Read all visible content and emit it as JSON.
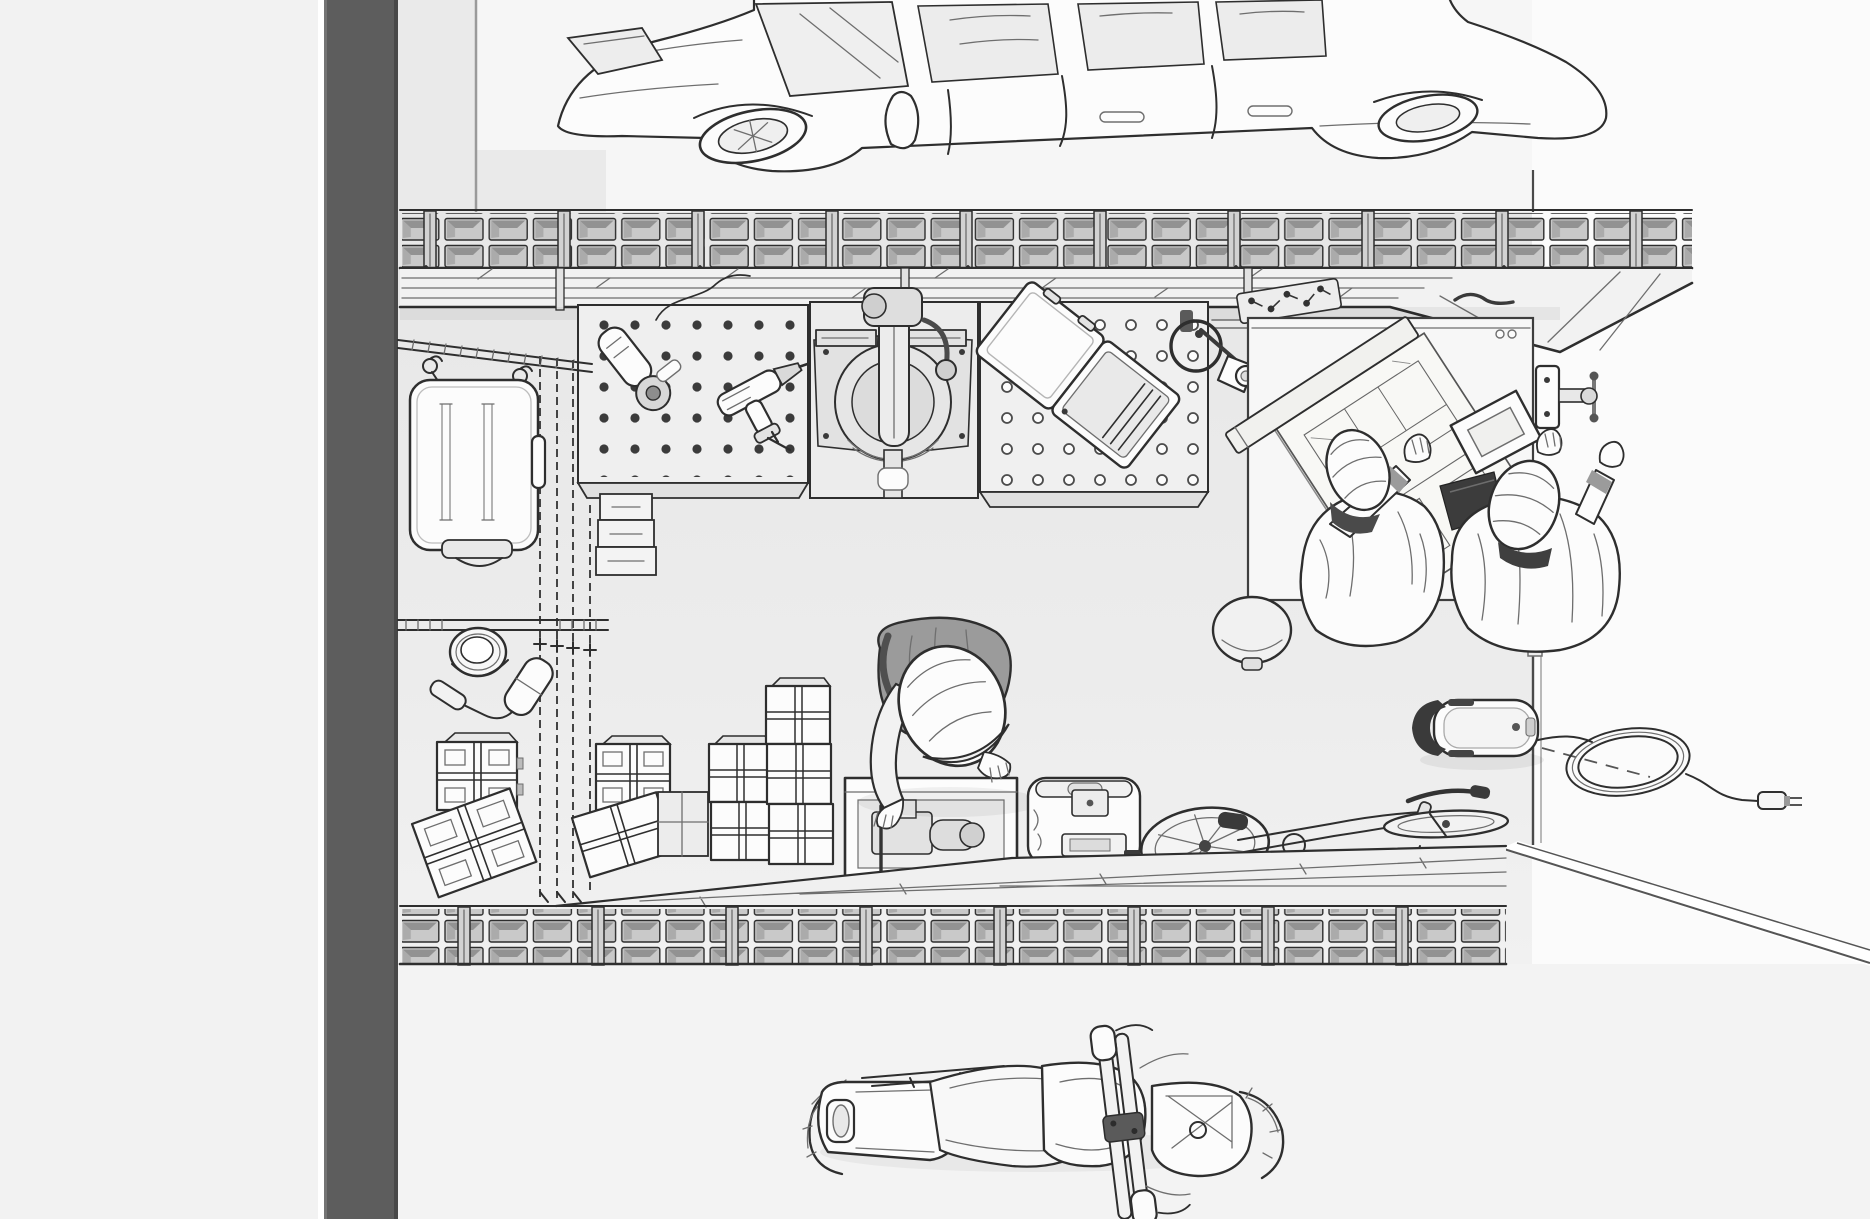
{
  "meta": {
    "title": "Garage workshop — top-down technical line illustration",
    "description": "Monochrome top-down illustration of a garage: car parked above a two-row bin storage wall, overhead plank shelf, three workbenches (pegboard with grinder and drill, miter saw, perforated bench with open tool case and clamp lamp), a drafting desk where two workers in ridged hard hats lean over blueprints with a straightedge, picture frame and bench vise, a rolling stool, wall rails with a hanging tool case, paint can and roller, cross-strapped moving boxes and box towers, a worker in a hard hat bending into an open crate of machine parts, a generator case, a bicycle, a robotic mower with a coiled power cord and plug at the doorway, a second bin wall with plank floor strip, and a motorcycle parked on the apron below.",
    "canvas": {
      "width": 1870,
      "height": 1219
    }
  },
  "colors": {
    "paper": "#fbfbfb",
    "margin": "#f2f2f2",
    "bar": "#5d5d5d",
    "bar-edge": "#484848",
    "ink": "#2e2e2e",
    "ink2": "#6e6e6e",
    "floor": "#e9e9e9",
    "floor2": "#f3f3f3",
    "white": "#fcfcfc",
    "grey": "#e3e3e3",
    "bin-face": "#c9c9c9",
    "bin-shade": "#929292",
    "shirt": "#9b9b9b",
    "dark": "#3a3a3a",
    "paperline": "#8a8a8a"
  },
  "objects": [
    {
      "name": "car",
      "label": "car parked along storage wall, top view"
    },
    {
      "name": "top-storage-rack",
      "label": "two-row open bin storage wall"
    },
    {
      "name": "overhead-plank-shelf",
      "label": "overhead plank shelf in perspective"
    },
    {
      "name": "pegboard-bench-left",
      "label": "pegboard workbench"
    },
    {
      "name": "angle-grinder",
      "label": "power grinder on bench"
    },
    {
      "name": "power-drill",
      "label": "cordless drill on bench"
    },
    {
      "name": "miter-saw",
      "label": "compound miter saw bench"
    },
    {
      "name": "pegboard-bench-right",
      "label": "perforated-top workbench"
    },
    {
      "name": "tool-case-open",
      "label": "open tool case on bench"
    },
    {
      "name": "desk-lamp",
      "label": "clamp-on articulated lamp"
    },
    {
      "name": "fastener-tray",
      "label": "tray of screws and bits"
    },
    {
      "name": "drafting-desk",
      "label": "planning desk"
    },
    {
      "name": "blueprints",
      "label": "floor-plan drawings"
    },
    {
      "name": "straightedge-board",
      "label": "long straightedge over drawings"
    },
    {
      "name": "picture-frame",
      "label": "framed plan on desk"
    },
    {
      "name": "bench-vise",
      "label": "vise on desk edge"
    },
    {
      "name": "worker-left",
      "label": "worker in ridged hard hat at desk"
    },
    {
      "name": "worker-right",
      "label": "second worker in hard hat at desk"
    },
    {
      "name": "clipboard",
      "label": "dark tablet between workers"
    },
    {
      "name": "rolling-stool",
      "label": "round stool"
    },
    {
      "name": "hanging-tool-case",
      "label": "large case hanging on wall rail"
    },
    {
      "name": "wall-rails",
      "label": "wall rails, hooks, vertical tracks"
    },
    {
      "name": "paint-can",
      "label": "open paint can"
    },
    {
      "name": "paint-roller",
      "label": "paint roller"
    },
    {
      "name": "strapped-boxes",
      "label": "cross-strapped storage boxes"
    },
    {
      "name": "box-towers",
      "label": "stacked box towers"
    },
    {
      "name": "step-drawers",
      "label": "stacked drawers under bench"
    },
    {
      "name": "work-crate",
      "label": "open crate with machine parts"
    },
    {
      "name": "worker-bending",
      "label": "worker bending over crate"
    },
    {
      "name": "generator-case",
      "label": "portable generator case"
    },
    {
      "name": "bicycle",
      "label": "bicycle on floor strip"
    },
    {
      "name": "robot-mower",
      "label": "robotic mower at doorway"
    },
    {
      "name": "power-cord",
      "label": "coiled cord with plug"
    },
    {
      "name": "bottom-storage-rack",
      "label": "front bin storage wall with plank strip"
    },
    {
      "name": "motorcycle",
      "label": "motorcycle on apron, top view"
    },
    {
      "name": "garage-structure",
      "label": "wall band, wall lines, floors, threshold"
    }
  ]
}
